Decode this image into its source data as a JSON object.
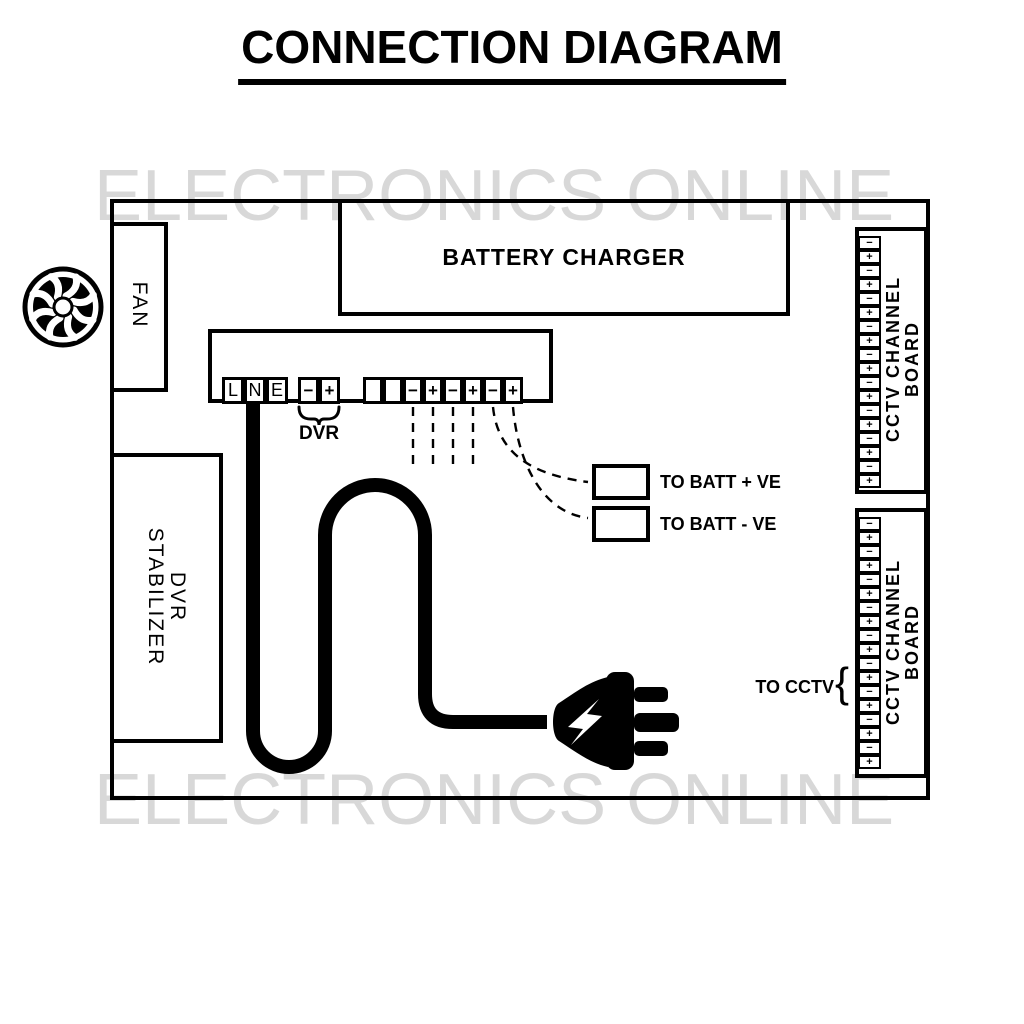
{
  "title": "CONNECTION DIAGRAM",
  "watermark": {
    "text": "ELECTRONICS ONLINE",
    "color": "#d8d8d8"
  },
  "fan": {
    "label": "FAN"
  },
  "battery_charger": {
    "label": "BATTERY CHARGER"
  },
  "dvr_stabilizer": {
    "line1": "DVR",
    "line2": "STABILIZER"
  },
  "terminal_strip": {
    "mains_terminals": [
      "L",
      "N",
      "E"
    ],
    "dvr_terminals": [
      "−",
      "+"
    ],
    "dvr_label": "DVR",
    "output_terminals": [
      "",
      "",
      "−",
      "+",
      "−",
      "+",
      "−",
      "+"
    ]
  },
  "batt_outputs": {
    "positive_label": "TO BATT + VE",
    "negative_label": "TO BATT - VE"
  },
  "cctv": {
    "to_cctv_label": "TO CCTV",
    "brace": "{",
    "board_line1": "CCTV CHANNEL",
    "board_line2": "BOARD",
    "terminals": [
      "−",
      "+",
      "−",
      "+",
      "−",
      "+",
      "−",
      "+",
      "−",
      "+",
      "−",
      "+",
      "−",
      "+",
      "−",
      "+",
      "−",
      "+"
    ]
  },
  "icons": {
    "fan": "fan-icon",
    "plug": "power-plug-icon",
    "bolt": "lightning-bolt-icon"
  },
  "colors": {
    "ink": "#000000",
    "watermark": "#d8d8d8",
    "background": "#ffffff"
  }
}
